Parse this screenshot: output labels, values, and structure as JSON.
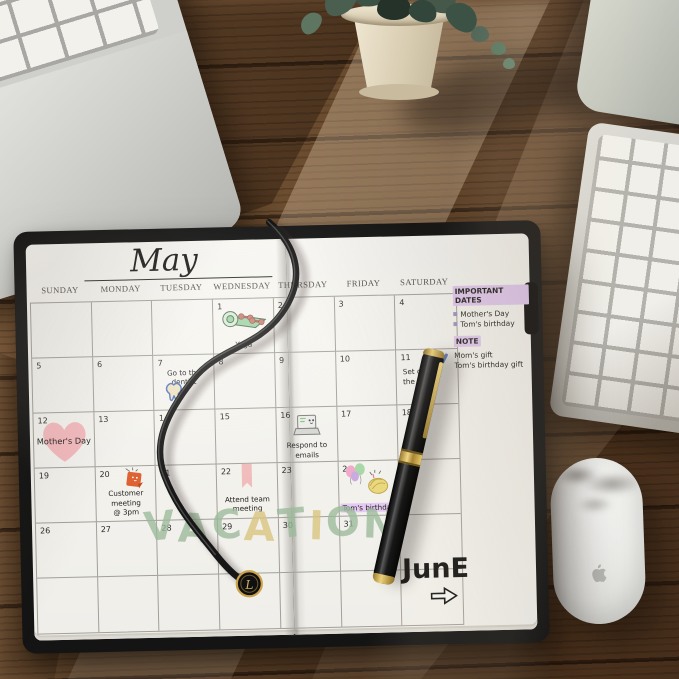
{
  "calendar": {
    "month_title": "May",
    "day_headers": [
      "SUNDAY",
      "MONDAY",
      "TUESDAY",
      "WEDNESDAY",
      "THURSDAY",
      "FRIDAY",
      "SATURDAY"
    ],
    "weeks": [
      [
        "",
        "",
        "",
        "1",
        "2",
        "3",
        "4"
      ],
      [
        "5",
        "6",
        "7",
        "8",
        "9",
        "10",
        "11"
      ],
      [
        "12",
        "13",
        "14",
        "15",
        "16",
        "17",
        "18"
      ],
      [
        "19",
        "20",
        "21",
        "22",
        "23",
        "24",
        "25"
      ],
      [
        "26",
        "27",
        "28",
        "29",
        "30",
        "31",
        ""
      ],
      [
        "",
        "",
        "",
        "",
        "",
        "",
        ""
      ]
    ],
    "events": {
      "may1": "Yoga",
      "may7": "Go to the dentist",
      "may11_line1": "Set g",
      "may11_line2": "the",
      "may12": "Mother's Day",
      "may16": "Respond to emails",
      "may20_line1": "Customer meeting",
      "may20_line2": "@ 3pm",
      "may22_line1": "Attend team",
      "may22_line2": "meeting",
      "may24": "Tom's birthday"
    },
    "vacation_letters": [
      {
        "ch": "V",
        "color": "#9cba9b"
      },
      {
        "ch": "A",
        "color": "#9cba9b"
      },
      {
        "ch": "C",
        "color": "#9cba9b"
      },
      {
        "ch": "A",
        "color": "#d9c57f"
      },
      {
        "ch": "T",
        "color": "#9cba9b"
      },
      {
        "ch": "I",
        "color": "#d9c57f"
      },
      {
        "ch": "O",
        "color": "#9cba9b"
      },
      {
        "ch": "N",
        "color": "#9cba9b"
      }
    ],
    "june_label": "JunE"
  },
  "notes_panel": {
    "important_title": "IMPORTANT DATES",
    "important_items": [
      "Mother's Day",
      "Tom's birthday"
    ],
    "note_title": "NOTE",
    "note_items": [
      "Mom's gift",
      "Tom's birthday gift"
    ]
  },
  "stickers": {
    "may1": "yoga-mat-and-dumbbells",
    "may7": "tooth-doodle",
    "may11": "mini-heart-and-pencil",
    "may12": "pink-heart",
    "may16": "laptop-smiley",
    "may20": "orange-sticky-note",
    "may22": "pink-ribbon-banner",
    "may24": "balloons-and-birthday-cake"
  },
  "scene_objects": [
    "laptop",
    "potted-plant",
    "monitor-stand",
    "external-keyboard",
    "magic-mouse",
    "planner-notebook",
    "fountain-pen",
    "elastic-cord-with-L-charm"
  ],
  "colors": {
    "page": "#f3f2ee",
    "cover_black": "#141414",
    "wood_brown": "#6e4f32",
    "highlight_purple": "#e2c9f0",
    "heart_pink": "#f3b6ba",
    "vacation_green": "#9cba9b",
    "vacation_tan": "#d9c57f",
    "pen_gold": "#e7c868"
  }
}
